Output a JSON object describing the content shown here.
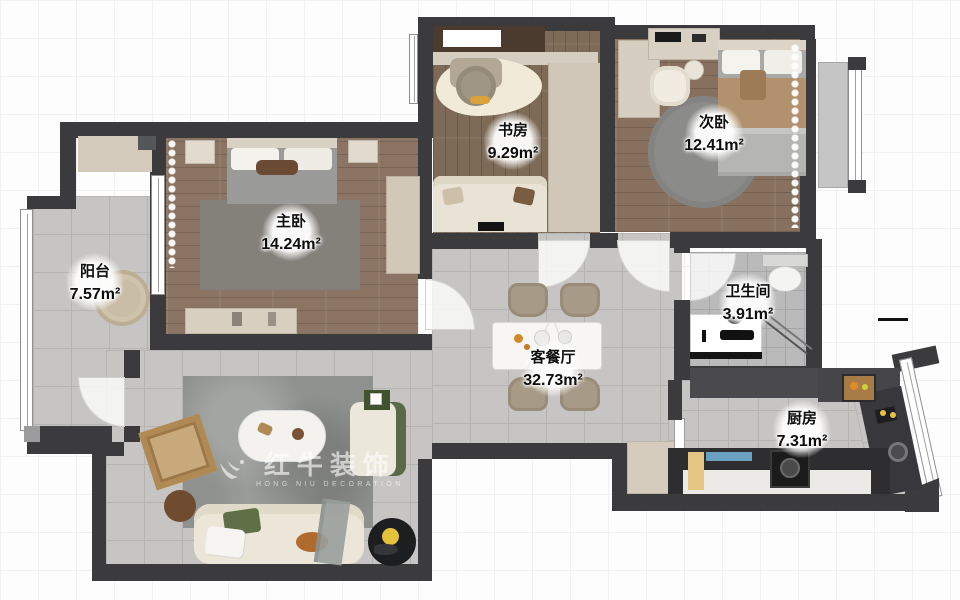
{
  "plan": {
    "rooms": [
      {
        "id": "balcony",
        "name": "阳台",
        "area": "7.57m²"
      },
      {
        "id": "master-bedroom",
        "name": "主卧",
        "area": "14.24m²"
      },
      {
        "id": "study",
        "name": "书房",
        "area": "9.29m²"
      },
      {
        "id": "second-bedroom",
        "name": "次卧",
        "area": "12.41m²"
      },
      {
        "id": "living-dining",
        "name": "客餐厅",
        "area": "32.73m²"
      },
      {
        "id": "bathroom",
        "name": "卫生间",
        "area": "3.91m²"
      },
      {
        "id": "kitchen",
        "name": "厨房",
        "area": "7.31m²"
      }
    ],
    "watermark": {
      "brand": "红牛装饰",
      "subtitle": "HONG NIU DECORATION",
      "logo": "bull-logo-icon"
    },
    "colors": {
      "wall": "#3b3b3d",
      "wood_floor": "#8b7463",
      "wood_floor_dark": "#7d6a57",
      "tile_floor": "#c7c5c3",
      "bath_tile": "#bababa",
      "rug_gray": "#8f918e",
      "cabinet_beige": "#d5ccbd",
      "counter_dark": "#2e2e30",
      "accent_green": "#5a6a48",
      "accent_orange": "#b06a2c",
      "accent_yellow": "#e5c23c",
      "accent_blue": "#6aa0c0"
    }
  }
}
